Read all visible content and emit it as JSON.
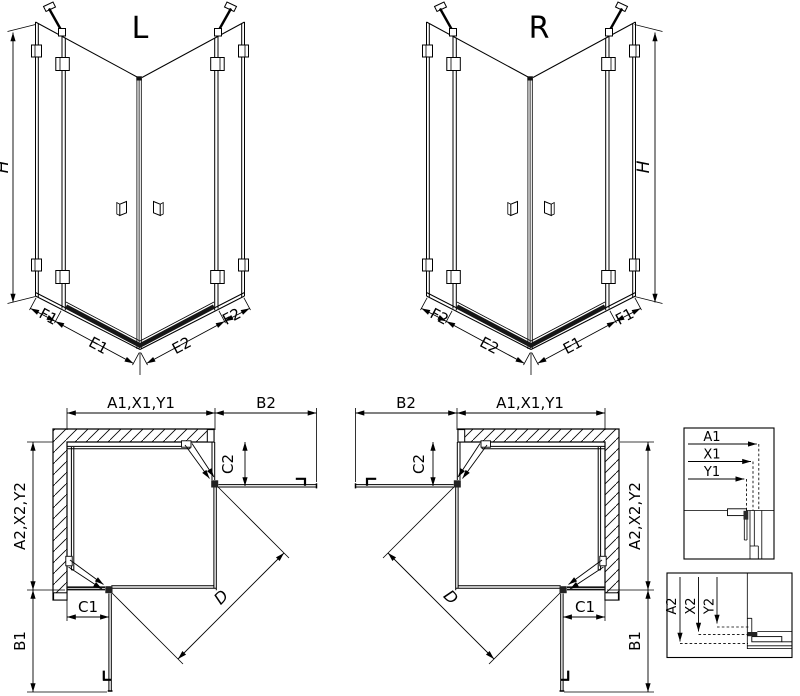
{
  "drawing": {
    "iso_left": {
      "title": "L",
      "height_label": "H",
      "bottom_labels": {
        "outer_left": "F1",
        "inner_left": "E1",
        "inner_right": "E2",
        "outer_right": "F2"
      }
    },
    "iso_right": {
      "title": "R",
      "height_label": "H",
      "bottom_labels": {
        "outer_left": "F2",
        "inner_left": "E2",
        "inner_right": "E1",
        "outer_right": "F1"
      }
    },
    "plan_left": {
      "width_label": "A1,X1,Y1",
      "door_width_label": "B2",
      "depth_label": "A2,X2,Y2",
      "door_depth_label": "B1",
      "top_offset_label": "C2",
      "side_offset_label": "C1",
      "diagonal_label": "D"
    },
    "plan_right": {
      "width_label": "A1,X1,Y1",
      "door_width_label": "B2",
      "depth_label": "A2,X2,Y2",
      "door_depth_label": "B1",
      "top_offset_label": "C2",
      "side_offset_label": "C1",
      "diagonal_label": "D"
    },
    "detail_horizontal": {
      "labels": [
        "A1",
        "X1",
        "Y1"
      ]
    },
    "detail_vertical": {
      "labels": [
        "A2",
        "X2",
        "Y2"
      ]
    }
  },
  "colors": {
    "background": "#ffffff",
    "line": "#000000"
  }
}
